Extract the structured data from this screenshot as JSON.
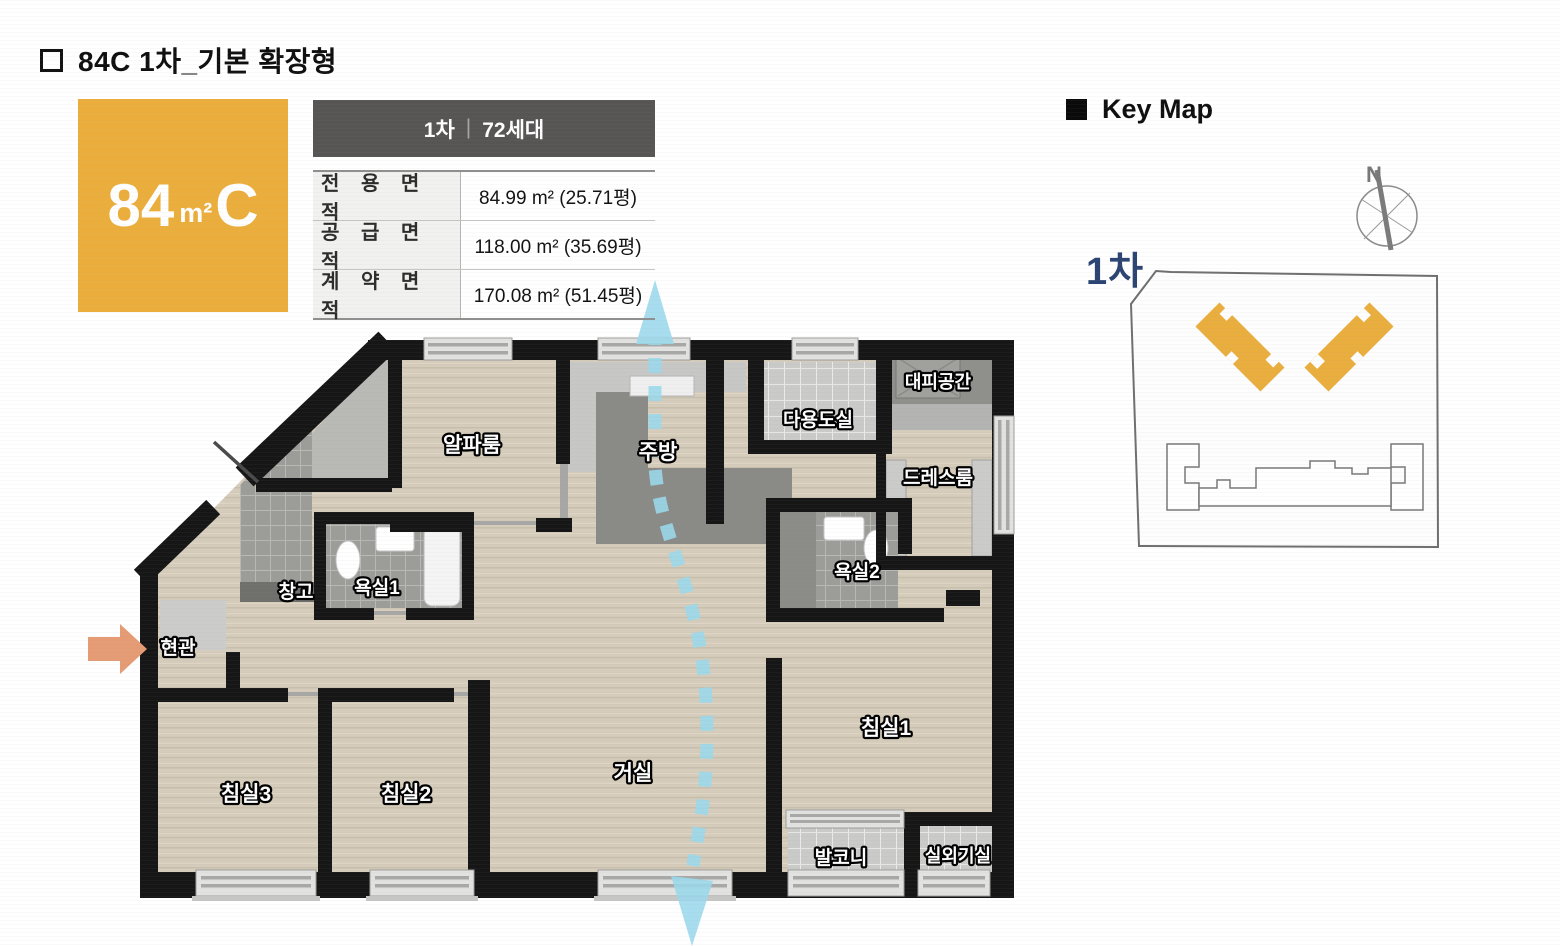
{
  "page": {
    "title": "84C 1차_기본 확장형"
  },
  "unit_badge": {
    "area": "84",
    "unit": "m²",
    "type": "C"
  },
  "spec_table": {
    "header": {
      "phase": "1차",
      "separator": "|",
      "households": "72세대"
    },
    "rows": [
      {
        "label": "전 용 면 적",
        "value": "84.99 m² (25.71평)"
      },
      {
        "label": "공 급 면 적",
        "value": "118.00 m² (35.69평)"
      },
      {
        "label": "계 약 면 적",
        "value": "170.08 m² (51.45평)"
      }
    ]
  },
  "key_map": {
    "title": "Key Map",
    "compass_label": "N",
    "phase_label": "1차"
  },
  "floor_plan": {
    "rooms": [
      {
        "id": "alpha-room",
        "label": "알파룸"
      },
      {
        "id": "kitchen",
        "label": "주방"
      },
      {
        "id": "utility-room",
        "label": "다용도실"
      },
      {
        "id": "refuge-space",
        "label": "대피공간"
      },
      {
        "id": "dress-room",
        "label": "드레스룸"
      },
      {
        "id": "bathroom2",
        "label": "욕실2"
      },
      {
        "id": "bathroom1",
        "label": "욕실1"
      },
      {
        "id": "storage",
        "label": "창고"
      },
      {
        "id": "entrance",
        "label": "현관"
      },
      {
        "id": "bedroom3",
        "label": "침실3"
      },
      {
        "id": "bedroom2",
        "label": "침실2"
      },
      {
        "id": "living-room",
        "label": "거실"
      },
      {
        "id": "bedroom1",
        "label": "침실1"
      },
      {
        "id": "balcony",
        "label": "발코니"
      },
      {
        "id": "outdoor-unit-room",
        "label": "실외기실"
      }
    ],
    "colors": {
      "wall": "#161616",
      "wood_floor": "#D5CCBB",
      "tile": "#9C9C98",
      "tile_light": "#CACAC8",
      "flow_arrow": "#9BD9EC",
      "entry_arrow": "#E59B74",
      "accent_orange": "#EBAE3C",
      "phase_text": "#2B4472",
      "table_header_bg": "#575554"
    }
  }
}
